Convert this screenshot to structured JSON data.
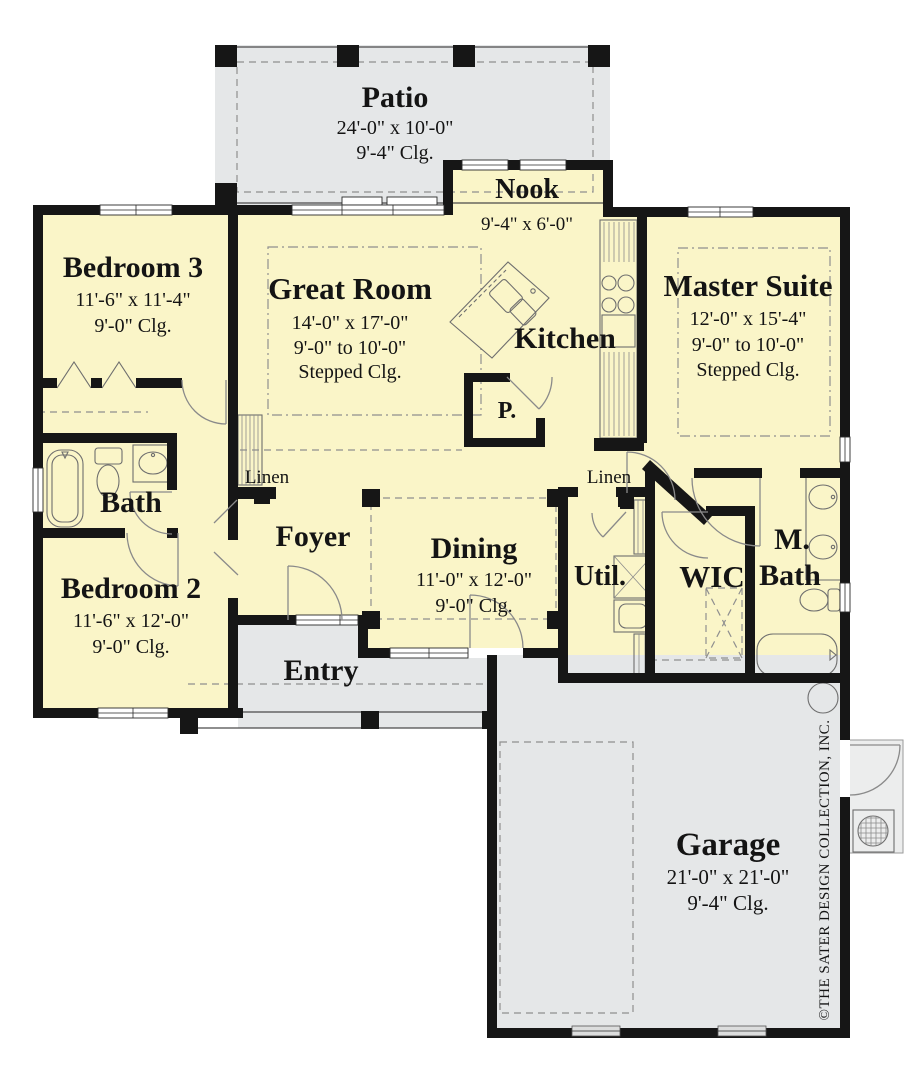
{
  "colors": {
    "floor_interior": "#FAF5C8",
    "floor_outdoor": "#E5E7E8",
    "stoop": "#ECEDED",
    "wall": "#161616"
  },
  "rooms": {
    "patio": {
      "name": "Patio",
      "dim": "24'-0\" x 10'-0\"",
      "clg": "9'-4\"  Clg."
    },
    "nook": {
      "name": "Nook",
      "dim": "9'-4\" x 6'-0\""
    },
    "bedroom3": {
      "name": "Bedroom 3",
      "dim": "11'-6\" x 11'-4\"",
      "clg": "9'-0\"  Clg."
    },
    "great_room": {
      "name": "Great Room",
      "dim": "14'-0\" x 17'-0\"",
      "clg_range": "9'-0\" to 10'-0\"",
      "clg_type": "Stepped Clg."
    },
    "kitchen": {
      "name": "Kitchen"
    },
    "pantry": {
      "name": "P."
    },
    "master_suite": {
      "name": "Master Suite",
      "dim": "12'-0\" x 15'-4\"",
      "clg_range": "9'-0\" to 10'-0\"",
      "clg_type": "Stepped Clg."
    },
    "bath": {
      "name": "Bath"
    },
    "linen_left": {
      "name": "Linen"
    },
    "linen_right": {
      "name": "Linen"
    },
    "foyer": {
      "name": "Foyer"
    },
    "dining": {
      "name": "Dining",
      "dim": "11'-0\" x 12'-0\"",
      "clg": "9'-0\"  Clg."
    },
    "utility": {
      "name": "Util."
    },
    "wic": {
      "name": "WIC"
    },
    "master_bath": {
      "line1": "M.",
      "line2": "Bath"
    },
    "bedroom2": {
      "name": "Bedroom 2",
      "dim": "11'-6\" x 12'-0\"",
      "clg": "9'-0\"  Clg."
    },
    "entry": {
      "name": "Entry"
    },
    "garage": {
      "name": "Garage",
      "dim": "21'-0\" x 21'-0\"",
      "clg": "9'-4\"  Clg."
    }
  },
  "copyright": "©THE SATER DESIGN COLLECTION, INC."
}
